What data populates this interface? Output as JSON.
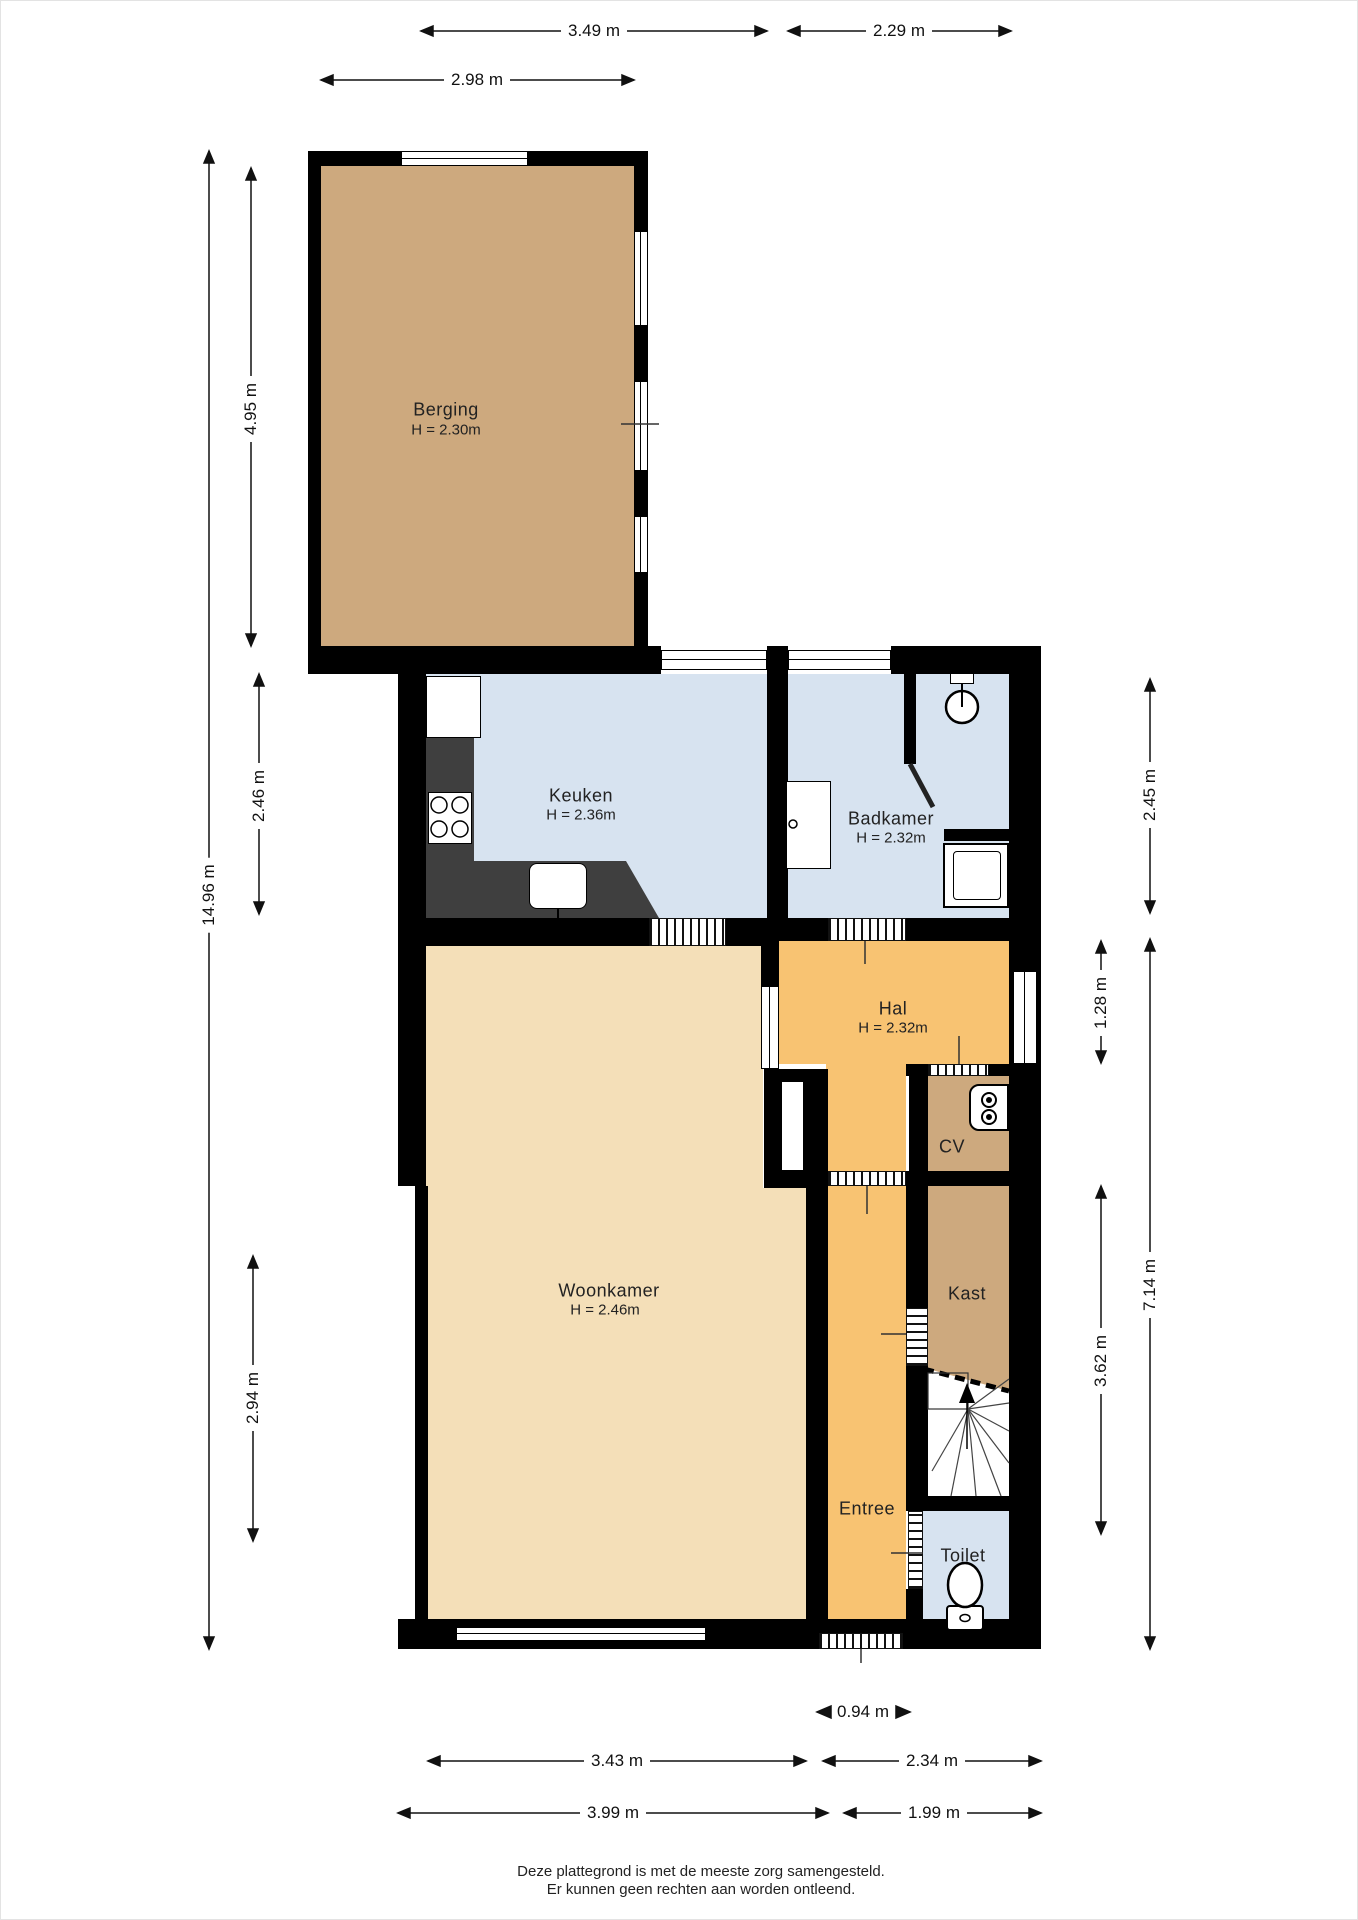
{
  "rooms": {
    "berging": {
      "name": "Berging",
      "height": "H = 2.30m"
    },
    "keuken": {
      "name": "Keuken",
      "height": "H = 2.36m"
    },
    "badkamer": {
      "name": "Badkamer",
      "height": "H = 2.32m"
    },
    "hal": {
      "name": "Hal",
      "height": "H = 2.32m"
    },
    "cv": {
      "name": "CV"
    },
    "woonkamer": {
      "name": "Woonkamer",
      "height": "H = 2.46m"
    },
    "kast": {
      "name": "Kast"
    },
    "entree": {
      "name": "Entree"
    },
    "toilet": {
      "name": "Toilet"
    }
  },
  "dimensions": {
    "top": {
      "d349": "3.49 m",
      "d229": "2.29 m",
      "d298": "2.98 m"
    },
    "left": {
      "d1496": "14.96 m",
      "d495": "4.95 m",
      "d246": "2.46 m",
      "d294": "2.94 m"
    },
    "right": {
      "d245": "2.45 m",
      "d128": "1.28 m",
      "d714": "7.14 m",
      "d362": "3.62 m"
    },
    "bottom": {
      "d094": "0.94 m",
      "d343": "3.43 m",
      "d234": "2.34 m",
      "d399": "3.99 m",
      "d199": "1.99 m"
    }
  },
  "footer": {
    "line1": "Deze plattegrond is met de meeste zorg samengesteld.",
    "line2": "Er kunnen geen rechten aan worden ontleend."
  },
  "colors": {
    "wall": "#000000",
    "wet_room_blue": "#d7e3f0",
    "hall_orange": "#f8c372",
    "living_beige": "#f4dfb8",
    "storage_tan": "#cda97e",
    "counter_gray": "#3f3f3f",
    "dimension_text": "#111111"
  }
}
